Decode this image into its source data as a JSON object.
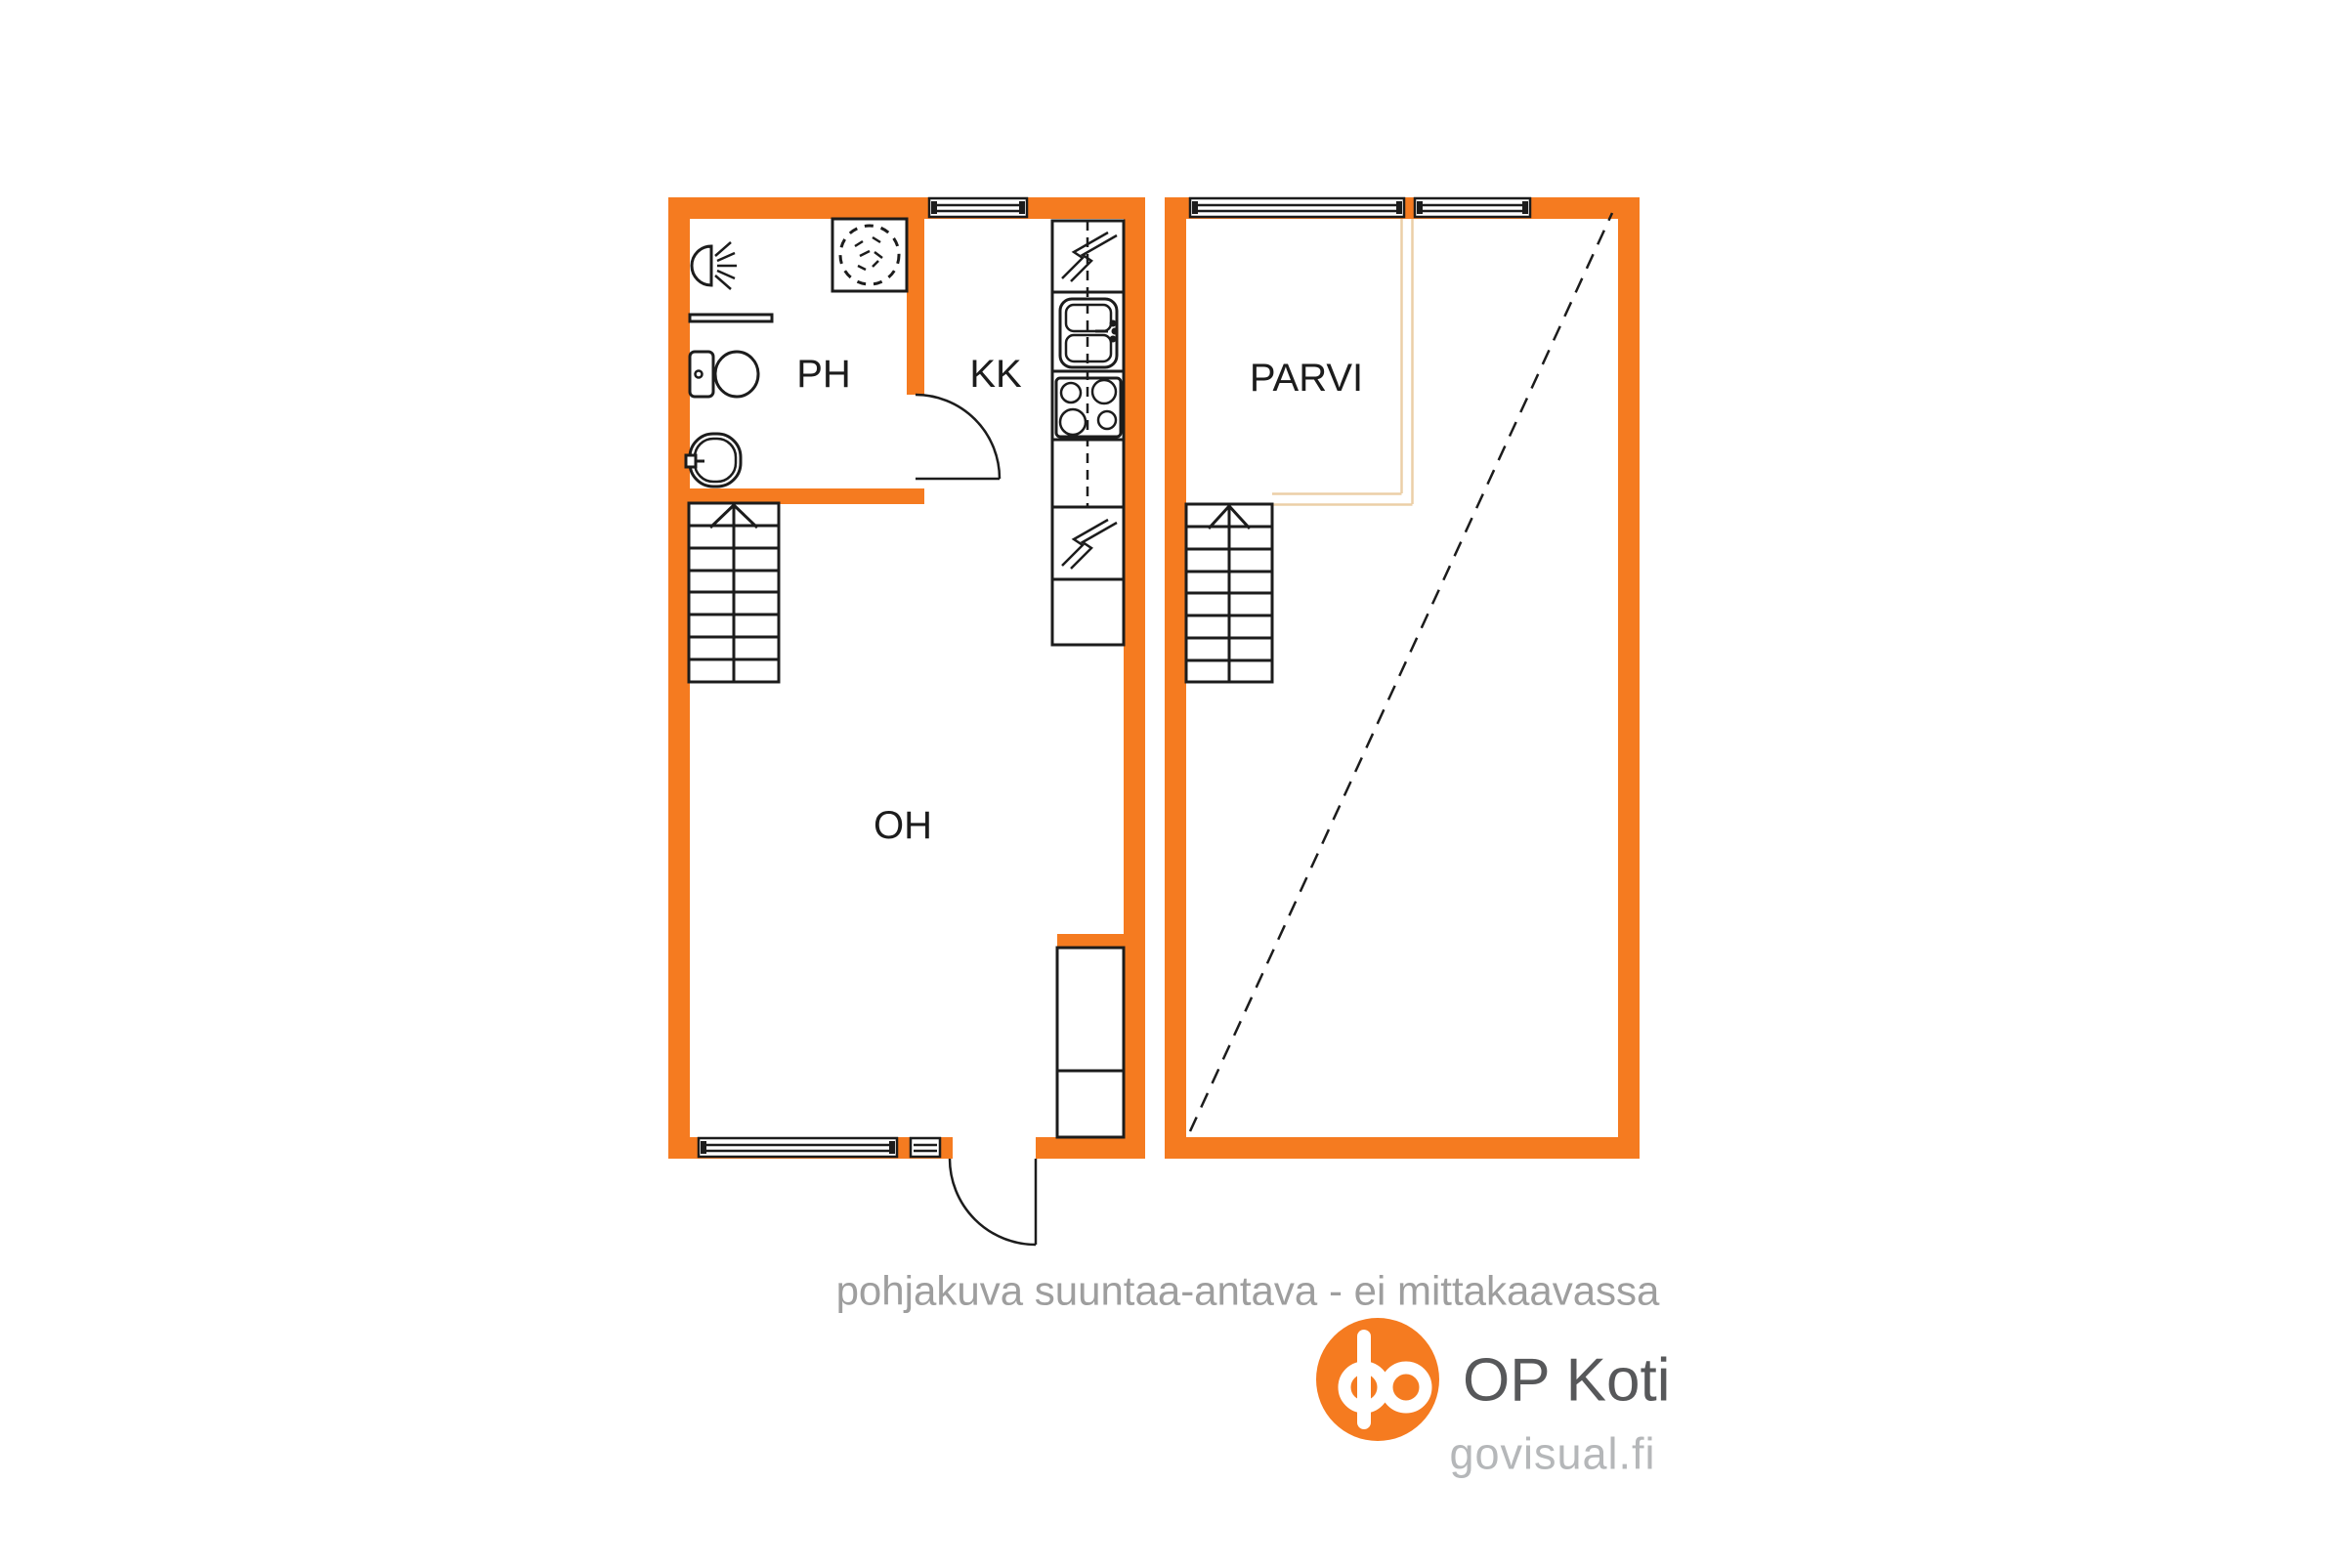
{
  "floorplan": {
    "rooms": {
      "ph": "PH",
      "kk": "KK",
      "oh": "OH",
      "parvi": "PARVI"
    },
    "disclaimer": "pohjakuva suuntaa-antava - ei mittakaavassa",
    "colors": {
      "wall": "#f57b20",
      "line": "#1c1c1c",
      "loft_edge": "#eccfa7",
      "disclaimer_text": "#9e9e9e",
      "brand_text": "#57585a",
      "site_text": "#b5b7b9",
      "logo_orange": "#f57b20"
    }
  },
  "branding": {
    "logo": "OP Koti",
    "site": "govisual.fi"
  }
}
